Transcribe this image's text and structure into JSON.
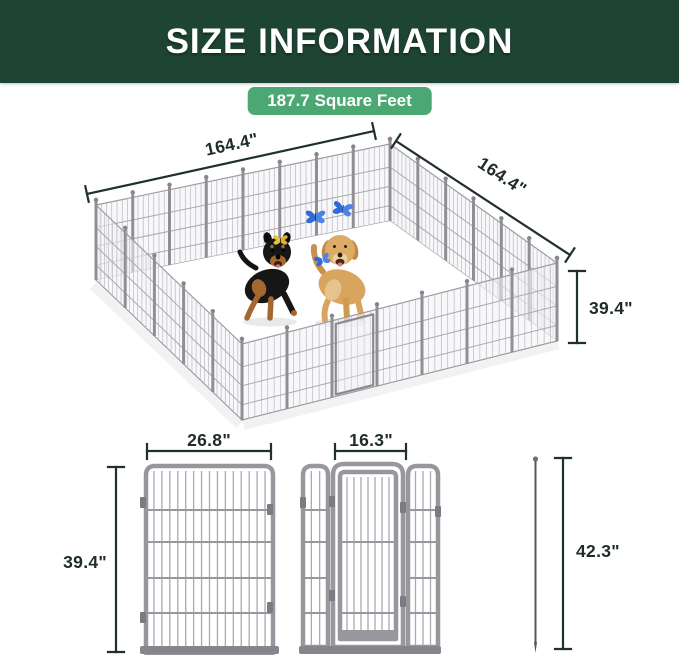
{
  "header": {
    "title": "SIZE INFORMATION"
  },
  "badge": {
    "label": "187.7 Square Feet"
  },
  "pen": {
    "top_width": "164.4\"",
    "side_width": "164.4\"",
    "height": "39.4\"",
    "scene": [
      "rottweiler-dog",
      "golden-retriever-dog",
      "blue-butterflies",
      "yellow-butterfly"
    ]
  },
  "panel": {
    "width": "26.8\"",
    "height": "39.4\""
  },
  "door_panel": {
    "width": "16.3\""
  },
  "stake": {
    "height": "42.3\""
  },
  "colors": {
    "header_bg": "#1E4434",
    "badge_green": "#4BA873",
    "dimension_ink": "#1F2D26",
    "fence_frame": "#97979D",
    "fence_wire": "#AFAFB5"
  }
}
